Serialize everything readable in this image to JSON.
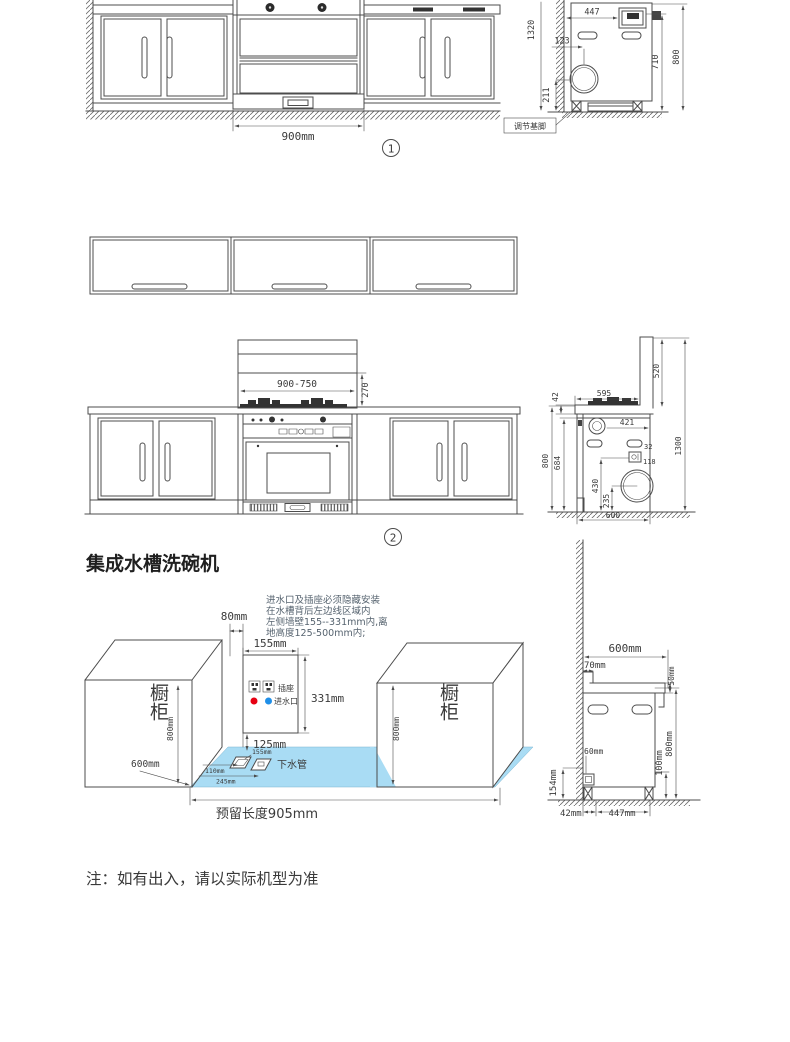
{
  "colors": {
    "floor_blue": "#a9dcf4",
    "hot_red": "#e60012",
    "cold_blue": "#1f8fe8",
    "line": "#4c4c4c"
  },
  "drawing1": {
    "number": "1",
    "front": {
      "width_dim": "900mm"
    },
    "side": {
      "top_depth": "447",
      "total_height": "1320",
      "drain_offset": "123",
      "drain_height": "211",
      "inner_height": "710",
      "body_height": "800",
      "feet_label": "调节基脚"
    }
  },
  "drawing2": {
    "number": "2",
    "front": {
      "hood_width": "900-750",
      "hood_section": "270"
    },
    "side": {
      "chimney_height": "520",
      "total_height": "1300",
      "counter_depth": "595",
      "counter_thickness": "42",
      "valve_offset": "421",
      "socket_gap": "32",
      "socket_drop": "118",
      "socket_height": "430",
      "drain_center": "235",
      "counter_height": "800",
      "cavity_height": "684",
      "body_depth": "600"
    }
  },
  "drawing3": {
    "title": "集成水槽洗碗机",
    "note_line1": "进水口及插座必须隐藏安装",
    "note_line2": "在水槽背后左边线区域内",
    "note_line3": "左侧墙壁155--331mm内,离",
    "note_line4": "地高度125-500mm内;",
    "plan": {
      "gap": "80mm",
      "recess_width": "155mm",
      "recess_height": "331mm",
      "recess_bottom": "125mm",
      "cabinet_height": "800mm",
      "cabinet_depth": "600mm",
      "left_cabinet": "橱柜",
      "right_cabinet": "橱柜",
      "right_cabinet_height": "800mm",
      "socket": "插座",
      "inlet": "进水口",
      "drain": "下水管",
      "floor_dim1": "155mm",
      "floor_dim2": "110mm",
      "floor_dim3": "245mm",
      "reserved": "预留长度905mm"
    },
    "side": {
      "depth": "600mm",
      "back_gap": "70mm",
      "counter_thickness": "50mm",
      "body_height": "800mm",
      "drain_max": "100mm",
      "drain_size": "60mm",
      "drain_height": "154mm",
      "wall_gap": "42mm",
      "feet_span": "447mm"
    }
  },
  "footer": {
    "note": "注：如有出入，请以实际机型为准"
  }
}
